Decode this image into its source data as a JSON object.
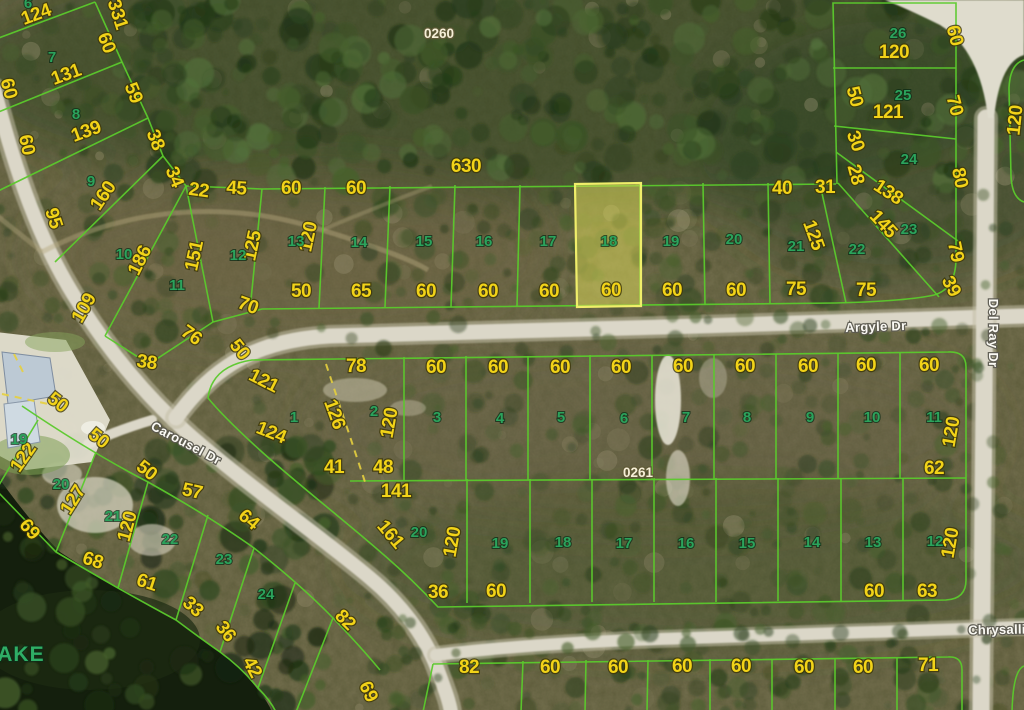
{
  "map": {
    "highlight": {
      "lot": "18",
      "block": "0260"
    },
    "block_labels": [
      {
        "t": "0260",
        "x": 439,
        "y": 38,
        "r": 0
      },
      {
        "t": "0261",
        "x": 638,
        "y": 477,
        "r": 0
      }
    ],
    "lake": {
      "t": "LAKE",
      "x": 14,
      "y": 661,
      "r": 0
    },
    "streets": [
      {
        "t": "Argyle Dr",
        "x": 876,
        "y": 331,
        "r": -2
      },
      {
        "t": "Del Ray Dr",
        "x": 989,
        "y": 333,
        "r": 90
      },
      {
        "t": "Carousel Dr",
        "x": 184,
        "y": 447,
        "r": 28
      },
      {
        "t": "Chrysalli",
        "x": 997,
        "y": 634,
        "r": -1
      }
    ],
    "lot_numbers": [
      {
        "t": "6",
        "x": 28,
        "y": 8
      },
      {
        "t": "7",
        "x": 52,
        "y": 62
      },
      {
        "t": "8",
        "x": 76,
        "y": 119
      },
      {
        "t": "9",
        "x": 91,
        "y": 186
      },
      {
        "t": "10",
        "x": 124,
        "y": 259
      },
      {
        "t": "11",
        "x": 177,
        "y": 290
      },
      {
        "t": "12",
        "x": 238,
        "y": 260
      },
      {
        "t": "13",
        "x": 296,
        "y": 246
      },
      {
        "t": "14",
        "x": 359,
        "y": 247
      },
      {
        "t": "15",
        "x": 424,
        "y": 246
      },
      {
        "t": "16",
        "x": 484,
        "y": 246
      },
      {
        "t": "17",
        "x": 548,
        "y": 246
      },
      {
        "t": "18",
        "x": 609,
        "y": 246
      },
      {
        "t": "19",
        "x": 671,
        "y": 246
      },
      {
        "t": "20",
        "x": 734,
        "y": 244
      },
      {
        "t": "21",
        "x": 796,
        "y": 251
      },
      {
        "t": "22",
        "x": 857,
        "y": 254
      },
      {
        "t": "23",
        "x": 909,
        "y": 234
      },
      {
        "t": "24",
        "x": 909,
        "y": 164
      },
      {
        "t": "25",
        "x": 903,
        "y": 100
      },
      {
        "t": "26",
        "x": 898,
        "y": 38
      },
      {
        "t": "1",
        "x": 294,
        "y": 422
      },
      {
        "t": "2",
        "x": 374,
        "y": 416
      },
      {
        "t": "3",
        "x": 437,
        "y": 422
      },
      {
        "t": "4",
        "x": 500,
        "y": 423
      },
      {
        "t": "5",
        "x": 561,
        "y": 422
      },
      {
        "t": "6",
        "x": 624,
        "y": 423
      },
      {
        "t": "7",
        "x": 686,
        "y": 422
      },
      {
        "t": "8",
        "x": 747,
        "y": 422
      },
      {
        "t": "9",
        "x": 810,
        "y": 422
      },
      {
        "t": "10",
        "x": 872,
        "y": 422
      },
      {
        "t": "11",
        "x": 934,
        "y": 422
      },
      {
        "t": "12",
        "x": 935,
        "y": 546
      },
      {
        "t": "13",
        "x": 873,
        "y": 547
      },
      {
        "t": "14",
        "x": 812,
        "y": 547
      },
      {
        "t": "15",
        "x": 747,
        "y": 548
      },
      {
        "t": "16",
        "x": 686,
        "y": 548
      },
      {
        "t": "17",
        "x": 624,
        "y": 548
      },
      {
        "t": "18",
        "x": 563,
        "y": 547
      },
      {
        "t": "19",
        "x": 500,
        "y": 548
      },
      {
        "t": "20",
        "x": 419,
        "y": 537
      },
      {
        "t": "19",
        "x": 19,
        "y": 444
      },
      {
        "t": "20",
        "x": 61,
        "y": 489
      },
      {
        "t": "21",
        "x": 113,
        "y": 521
      },
      {
        "t": "22",
        "x": 170,
        "y": 544
      },
      {
        "t": "23",
        "x": 224,
        "y": 564
      },
      {
        "t": "24",
        "x": 266,
        "y": 599
      }
    ],
    "dimensions": [
      {
        "t": "331",
        "x": 112,
        "y": 16,
        "r": 72
      },
      {
        "t": "124",
        "x": 38,
        "y": 20,
        "r": -20
      },
      {
        "t": "60",
        "x": 101,
        "y": 45,
        "r": 68
      },
      {
        "t": "131",
        "x": 68,
        "y": 80,
        "r": -20
      },
      {
        "t": "59",
        "x": 128,
        "y": 95,
        "r": 68
      },
      {
        "t": "60",
        "x": 3,
        "y": 90,
        "r": 75
      },
      {
        "t": "139",
        "x": 88,
        "y": 137,
        "r": -20
      },
      {
        "t": "38",
        "x": 150,
        "y": 142,
        "r": 68
      },
      {
        "t": "60",
        "x": 21,
        "y": 146,
        "r": 78
      },
      {
        "t": "34",
        "x": 169,
        "y": 179,
        "r": 68
      },
      {
        "t": "160",
        "x": 108,
        "y": 199,
        "r": -56
      },
      {
        "t": "95",
        "x": 48,
        "y": 220,
        "r": 72
      },
      {
        "t": "186",
        "x": 145,
        "y": 263,
        "r": -64
      },
      {
        "t": "109",
        "x": 89,
        "y": 311,
        "r": -60
      },
      {
        "t": "151",
        "x": 200,
        "y": 257,
        "r": -78
      },
      {
        "t": "22",
        "x": 198,
        "y": 196,
        "r": 8
      },
      {
        "t": "45",
        "x": 236,
        "y": 194,
        "r": 4
      },
      {
        "t": "60",
        "x": 291,
        "y": 194,
        "r": 0
      },
      {
        "t": "60",
        "x": 356,
        "y": 194,
        "r": 0
      },
      {
        "t": "630",
        "x": 466,
        "y": 172,
        "r": 0
      },
      {
        "t": "125",
        "x": 258,
        "y": 247,
        "r": -78
      },
      {
        "t": "120",
        "x": 314,
        "y": 238,
        "r": -78
      },
      {
        "t": "70",
        "x": 246,
        "y": 311,
        "r": 20
      },
      {
        "t": "76",
        "x": 188,
        "y": 340,
        "r": 35
      },
      {
        "t": "38",
        "x": 146,
        "y": 368,
        "r": 8
      },
      {
        "t": "50",
        "x": 301,
        "y": 297,
        "r": 0
      },
      {
        "t": "65",
        "x": 361,
        "y": 297,
        "r": 0
      },
      {
        "t": "60",
        "x": 426,
        "y": 297,
        "r": 0
      },
      {
        "t": "60",
        "x": 488,
        "y": 297,
        "r": 0
      },
      {
        "t": "60",
        "x": 549,
        "y": 297,
        "r": 0
      },
      {
        "t": "60",
        "x": 611,
        "y": 296,
        "r": 0
      },
      {
        "t": "60",
        "x": 672,
        "y": 296,
        "r": 0
      },
      {
        "t": "60",
        "x": 736,
        "y": 296,
        "r": 0
      },
      {
        "t": "75",
        "x": 796,
        "y": 295,
        "r": 0
      },
      {
        "t": "75",
        "x": 866,
        "y": 296,
        "r": 0
      },
      {
        "t": "40",
        "x": 782,
        "y": 194,
        "r": 0
      },
      {
        "t": "31",
        "x": 825,
        "y": 193,
        "r": 0
      },
      {
        "t": "125",
        "x": 808,
        "y": 237,
        "r": 70
      },
      {
        "t": "28",
        "x": 850,
        "y": 176,
        "r": 75
      },
      {
        "t": "30",
        "x": 850,
        "y": 143,
        "r": 70
      },
      {
        "t": "50",
        "x": 849,
        "y": 98,
        "r": 75
      },
      {
        "t": "120",
        "x": 894,
        "y": 58,
        "r": 0
      },
      {
        "t": "121",
        "x": 888,
        "y": 118,
        "r": 0
      },
      {
        "t": "138",
        "x": 885,
        "y": 197,
        "r": 33
      },
      {
        "t": "145",
        "x": 879,
        "y": 228,
        "r": 47
      },
      {
        "t": "60",
        "x": 949,
        "y": 37,
        "r": 75
      },
      {
        "t": "70",
        "x": 949,
        "y": 107,
        "r": 75
      },
      {
        "t": "80",
        "x": 954,
        "y": 179,
        "r": 78
      },
      {
        "t": "79",
        "x": 950,
        "y": 253,
        "r": 78
      },
      {
        "t": "39",
        "x": 946,
        "y": 289,
        "r": 62
      },
      {
        "t": "120",
        "x": 1021,
        "y": 121,
        "r": -84
      },
      {
        "t": "121",
        "x": 261,
        "y": 386,
        "r": 27
      },
      {
        "t": "78",
        "x": 356,
        "y": 372,
        "r": 0
      },
      {
        "t": "126",
        "x": 329,
        "y": 416,
        "r": 70
      },
      {
        "t": "120",
        "x": 395,
        "y": 424,
        "r": -80
      },
      {
        "t": "124",
        "x": 269,
        "y": 438,
        "r": 22
      },
      {
        "t": "41",
        "x": 334,
        "y": 473,
        "r": 0
      },
      {
        "t": "48",
        "x": 383,
        "y": 473,
        "r": 0
      },
      {
        "t": "141",
        "x": 396,
        "y": 497,
        "r": 0
      },
      {
        "t": "60",
        "x": 436,
        "y": 373,
        "r": 0
      },
      {
        "t": "60",
        "x": 498,
        "y": 373,
        "r": 0
      },
      {
        "t": "60",
        "x": 560,
        "y": 373,
        "r": 0
      },
      {
        "t": "60",
        "x": 621,
        "y": 373,
        "r": 0
      },
      {
        "t": "60",
        "x": 683,
        "y": 372,
        "r": 0
      },
      {
        "t": "60",
        "x": 745,
        "y": 372,
        "r": 0
      },
      {
        "t": "60",
        "x": 808,
        "y": 372,
        "r": 0
      },
      {
        "t": "60",
        "x": 866,
        "y": 371,
        "r": 0
      },
      {
        "t": "60",
        "x": 929,
        "y": 371,
        "r": 0
      },
      {
        "t": "120",
        "x": 957,
        "y": 433,
        "r": -80
      },
      {
        "t": "62",
        "x": 934,
        "y": 474,
        "r": 0
      },
      {
        "t": "161",
        "x": 386,
        "y": 538,
        "r": 50
      },
      {
        "t": "120",
        "x": 458,
        "y": 543,
        "r": -80
      },
      {
        "t": "36",
        "x": 438,
        "y": 598,
        "r": 0
      },
      {
        "t": "60",
        "x": 496,
        "y": 597,
        "r": 0
      },
      {
        "t": "60",
        "x": 874,
        "y": 597,
        "r": 0
      },
      {
        "t": "63",
        "x": 927,
        "y": 597,
        "r": 0
      },
      {
        "t": "120",
        "x": 956,
        "y": 544,
        "r": -80
      },
      {
        "t": "82",
        "x": 341,
        "y": 624,
        "r": 45
      },
      {
        "t": "50",
        "x": 54,
        "y": 407,
        "r": 38
      },
      {
        "t": "122",
        "x": 28,
        "y": 461,
        "r": -55
      },
      {
        "t": "50",
        "x": 95,
        "y": 443,
        "r": 38
      },
      {
        "t": "127",
        "x": 78,
        "y": 503,
        "r": -58
      },
      {
        "t": "50",
        "x": 143,
        "y": 475,
        "r": 38
      },
      {
        "t": "50",
        "x": 235,
        "y": 353,
        "r": 52
      },
      {
        "t": "57",
        "x": 191,
        "y": 497,
        "r": 12
      },
      {
        "t": "69",
        "x": 25,
        "y": 533,
        "r": 50
      },
      {
        "t": "120",
        "x": 133,
        "y": 528,
        "r": -75
      },
      {
        "t": "64",
        "x": 245,
        "y": 524,
        "r": 40
      },
      {
        "t": "68",
        "x": 91,
        "y": 566,
        "r": 18
      },
      {
        "t": "61",
        "x": 145,
        "y": 588,
        "r": 18
      },
      {
        "t": "33",
        "x": 189,
        "y": 611,
        "r": 42
      },
      {
        "t": "36",
        "x": 221,
        "y": 635,
        "r": 52
      },
      {
        "t": "42",
        "x": 247,
        "y": 670,
        "r": 62
      },
      {
        "t": "69",
        "x": 363,
        "y": 694,
        "r": 65
      },
      {
        "t": "82",
        "x": 469,
        "y": 673,
        "r": 0
      },
      {
        "t": "60",
        "x": 550,
        "y": 673,
        "r": 0
      },
      {
        "t": "60",
        "x": 618,
        "y": 673,
        "r": 0
      },
      {
        "t": "60",
        "x": 682,
        "y": 672,
        "r": 0
      },
      {
        "t": "60",
        "x": 741,
        "y": 672,
        "r": 0
      },
      {
        "t": "60",
        "x": 804,
        "y": 673,
        "r": 0
      },
      {
        "t": "60",
        "x": 863,
        "y": 673,
        "r": 0
      },
      {
        "t": "71",
        "x": 928,
        "y": 671,
        "r": 0
      }
    ]
  },
  "colors": {
    "parcel_line": "#5bc92c",
    "highlight_fill": "#dedb5a",
    "highlight_stroke": "#f0ee6a",
    "dimension_text": "#f2d318",
    "lot_text": "#2ba35c",
    "street_text": "#fbfaf4",
    "block_text": "#f6efd7",
    "water": "#141f0d"
  }
}
